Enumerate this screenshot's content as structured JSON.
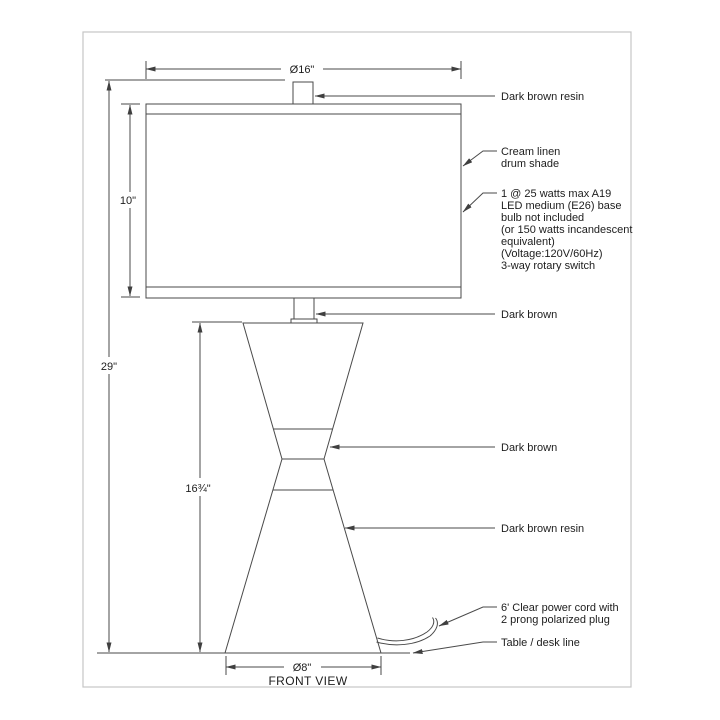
{
  "page": {
    "view_label": "FRONT VIEW"
  },
  "dimensions": {
    "shade_diameter": "Ø16\"",
    "shade_height": "10\"",
    "overall_height": "29\"",
    "body_height": "16¾\"",
    "base_diameter": "Ø8\""
  },
  "annotations": {
    "finial": "Dark brown resin",
    "shade": {
      "line1": "Cream linen",
      "line2": "drum shade"
    },
    "bulb": {
      "lines": [
        "1 @ 25 watts max A19",
        "LED medium (E26) base",
        "bulb not included",
        "(or 150 watts incandescent",
        "equivalent)",
        "(Voltage:120V/60Hz)",
        "3-way rotary switch"
      ]
    },
    "neck": "Dark brown",
    "waist": "Dark brown",
    "lower_body": "Dark brown resin",
    "cord": {
      "line1": "6' Clear power cord with",
      "line2": "2 prong polarized plug"
    },
    "table": "Table / desk line"
  },
  "colors": {
    "line": "#4a4a4a",
    "text": "#1d1d1d",
    "frame": "#c6c6c6",
    "background": "#ffffff"
  }
}
